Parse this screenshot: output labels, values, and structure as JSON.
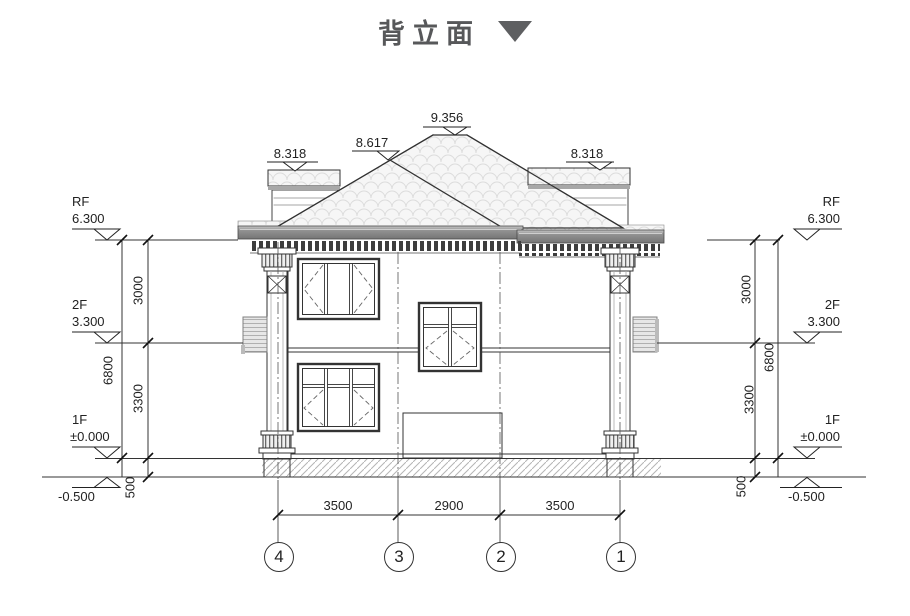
{
  "title": {
    "text": "背立面"
  },
  "roof_elevations": {
    "peak": "9.356",
    "mid_ridge": "8.617",
    "left_eave": "8.318",
    "right_eave": "8.318"
  },
  "levels": {
    "rf": {
      "label": "RF",
      "value": "6.300"
    },
    "f2": {
      "label": "2F",
      "value": "3.300"
    },
    "f1": {
      "label": "1F",
      "value": "±0.000"
    },
    "ground": {
      "value": "-0.500"
    }
  },
  "vertical_dims": {
    "story_upper": "3000",
    "story_lower": "3300",
    "plinth": "500",
    "total": "6800"
  },
  "bottom_dims": {
    "left": "3500",
    "middle": "2900",
    "right": "3500"
  },
  "grid_axes": [
    "4",
    "3",
    "2",
    "1"
  ],
  "colors": {
    "line": "#333333",
    "cornice": "#8f8f8f",
    "text": "#222222"
  }
}
